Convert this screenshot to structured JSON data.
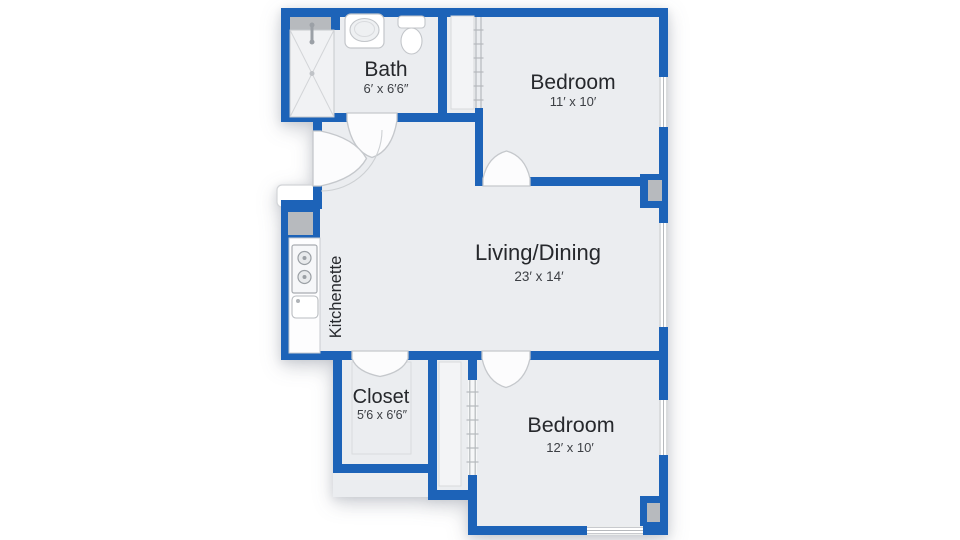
{
  "page": {
    "background": "#ffffff"
  },
  "floorplan": {
    "rooms": [
      {
        "name": "Bath",
        "dims": "6′ x 6′6″"
      },
      {
        "name": "Bedroom",
        "dims": "11′ x 10′"
      },
      {
        "name": "Living/Dining",
        "dims": "23′ x 14′"
      },
      {
        "name": "Kitchenette",
        "dims": ""
      },
      {
        "name": "Closet",
        "dims": "5′6 x 6′6″"
      },
      {
        "name": "Bedroom",
        "dims": "12′ x 10′"
      }
    ],
    "colors": {
      "wall": "#1d63b8",
      "room_fill": "#ebedf0",
      "fixture_outline": "#c3c6ca",
      "fixture_fill": "#b7babe",
      "label_text": "#26282c",
      "dimension_text": "#3c3f44",
      "window_line": "#b6b9bd"
    },
    "fixtures": [
      "shower",
      "bathtub",
      "toilet",
      "refrigerator",
      "stove",
      "sink"
    ]
  }
}
